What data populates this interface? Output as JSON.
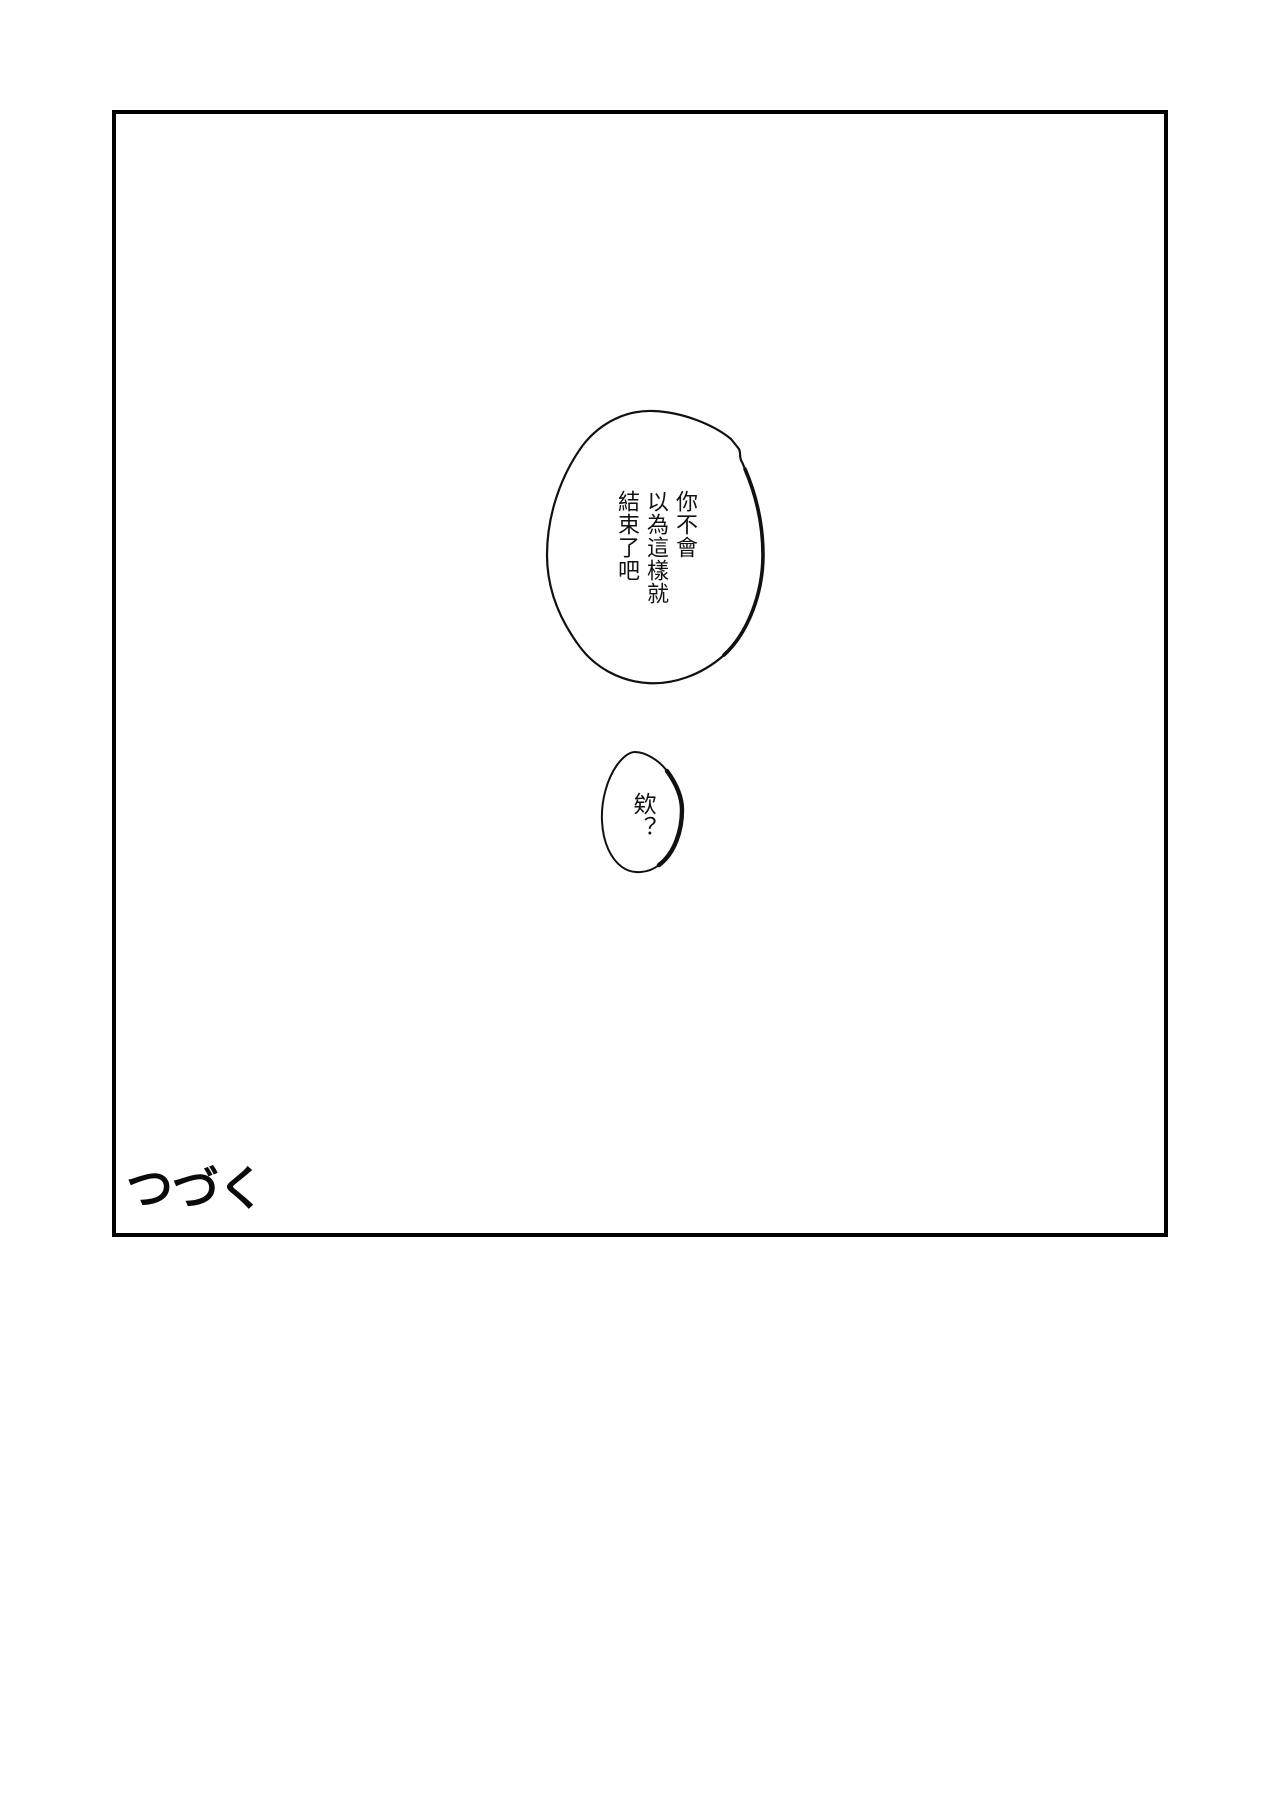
{
  "page": {
    "background_color": "#ffffff",
    "ink_color": "#111111"
  },
  "panel": {
    "border_color": "#000000"
  },
  "bubbles": {
    "large": {
      "lines": [
        "你不會",
        "以為這樣就",
        "結束了吧"
      ]
    },
    "small": {
      "lines": [
        "欸？"
      ]
    }
  },
  "footer": {
    "to_be_continued": "つづく"
  }
}
